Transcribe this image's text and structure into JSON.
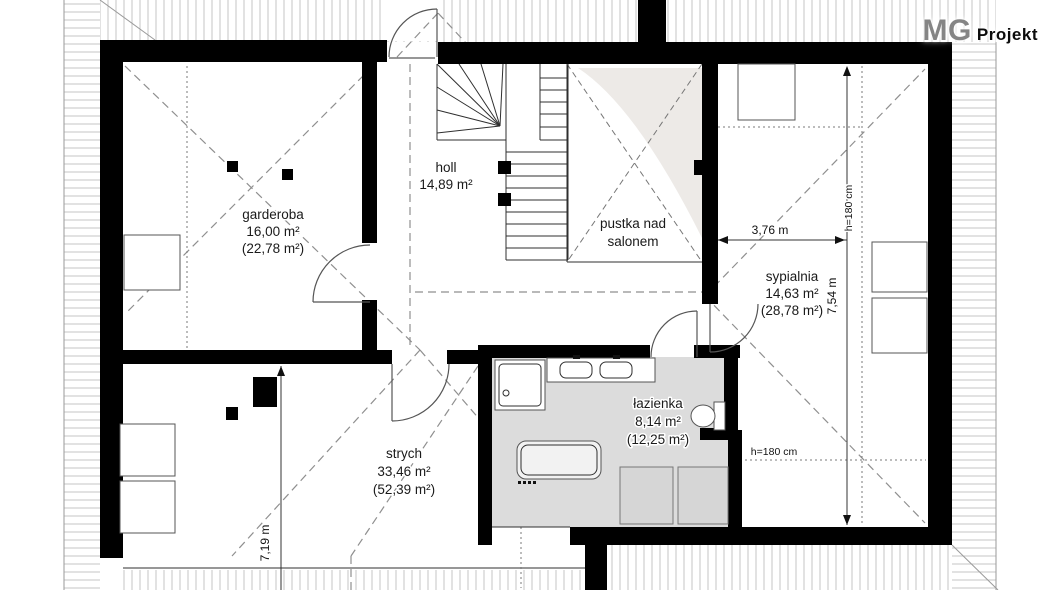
{
  "brand": {
    "mg": "MG",
    "projekt": "Projekt"
  },
  "rooms": {
    "garderoba": {
      "lines": [
        "garderoba",
        "16,00 m²",
        "(22,78 m²)"
      ]
    },
    "holl": {
      "lines": [
        "holl",
        "14,89 m²"
      ]
    },
    "pustka_nad_salonem": {
      "lines": [
        "pustka nad",
        "salonem"
      ]
    },
    "sypialnia": {
      "lines": [
        "sypialnia",
        "14,63 m²",
        "(28,78 m²)"
      ]
    },
    "lazienka": {
      "lines": [
        "łazienka",
        "8,14 m²",
        "(12,25 m²)"
      ]
    },
    "strych": {
      "lines": [
        "strych",
        "33,46 m²",
        "(52,39 m²)"
      ]
    }
  },
  "dimensions": {
    "bedroom_width": "3,76 m",
    "bedroom_depth": "7,54 m",
    "strych_depth": "7,19 m",
    "knee_wall_right": "h=180 cm",
    "knee_wall_bottom": "h=180 cm"
  },
  "colors": {
    "wall": "#000000",
    "bathroom_floor": "#dcdcdc",
    "furniture_gray": "#d6d6d6",
    "hatch": "#c6c6c6",
    "dashed": "#8f8f8f",
    "text": "#1a1a1a"
  }
}
